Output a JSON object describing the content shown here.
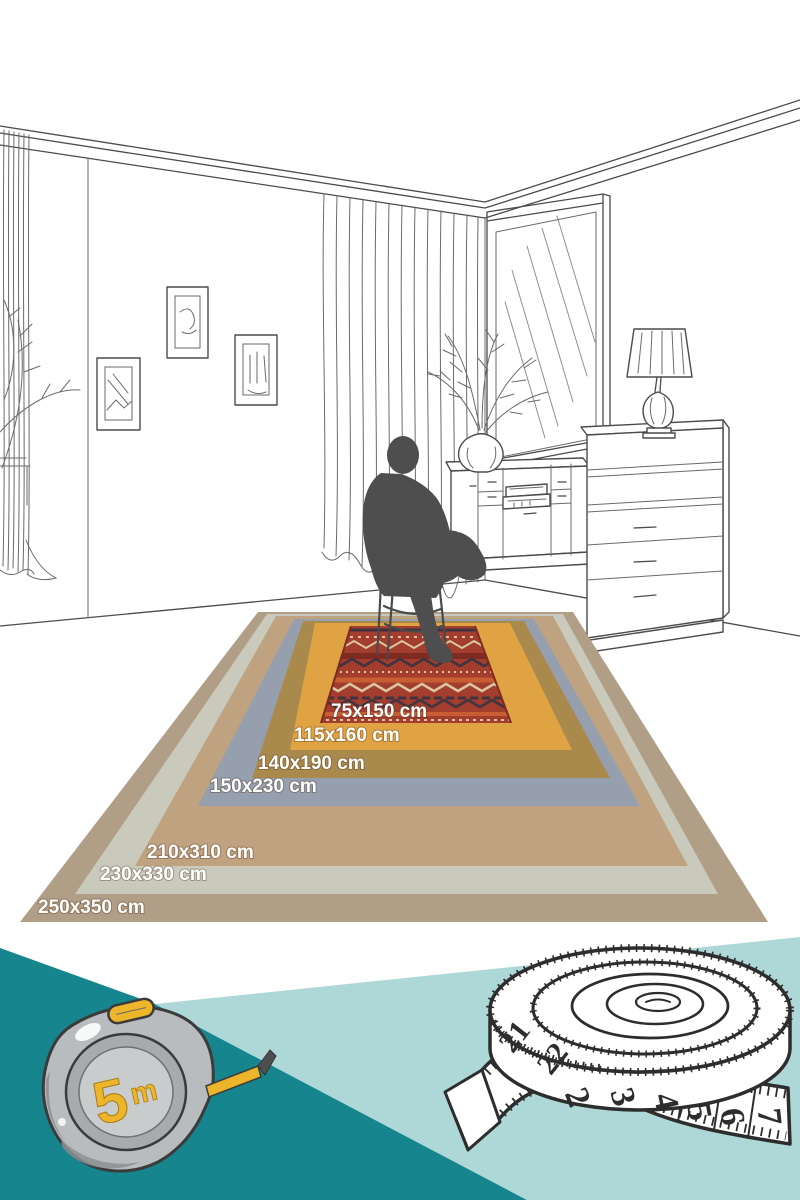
{
  "rugs": [
    {
      "size_label": "250x350 cm",
      "color": "#b19e86"
    },
    {
      "size_label": "230x330 cm",
      "color": "#c9cabc"
    },
    {
      "size_label": "210x310 cm",
      "color": "#bfa380"
    },
    {
      "size_label": "150x230 cm",
      "color": "#959fad"
    },
    {
      "size_label": "140x190 cm",
      "color": "#aa8a4c"
    },
    {
      "size_label": "115x160 cm",
      "color": "#dfa343"
    },
    {
      "size_label": "75x150 cm",
      "color": "#a33d2e"
    }
  ],
  "red_rug_pattern": {
    "dark": "#3f3340",
    "cream": "#d8c7a2",
    "orange": "#c75f32",
    "deep_red": "#7e2b22"
  },
  "tape_measure": {
    "capacity_number": "5",
    "capacity_unit": "m",
    "body_color": "#b9bcbe",
    "ring_color": "#a8abad",
    "face_color": "#c9cccd",
    "accent_yellow": "#edb62a",
    "shade_color": "#8d9092"
  },
  "tailor_tape": {
    "coil_numbers": [
      "21",
      "22"
    ],
    "tail_numbers": [
      "2",
      "3",
      "4",
      "5",
      "6",
      "7"
    ]
  },
  "palette": {
    "teal_dark": "#16858d",
    "teal_light": "#aed8d8",
    "line_art": "#4b4b4b",
    "silhouette": "#4e4e4e",
    "label_text": "#ffffff",
    "background": "#ffffff"
  }
}
